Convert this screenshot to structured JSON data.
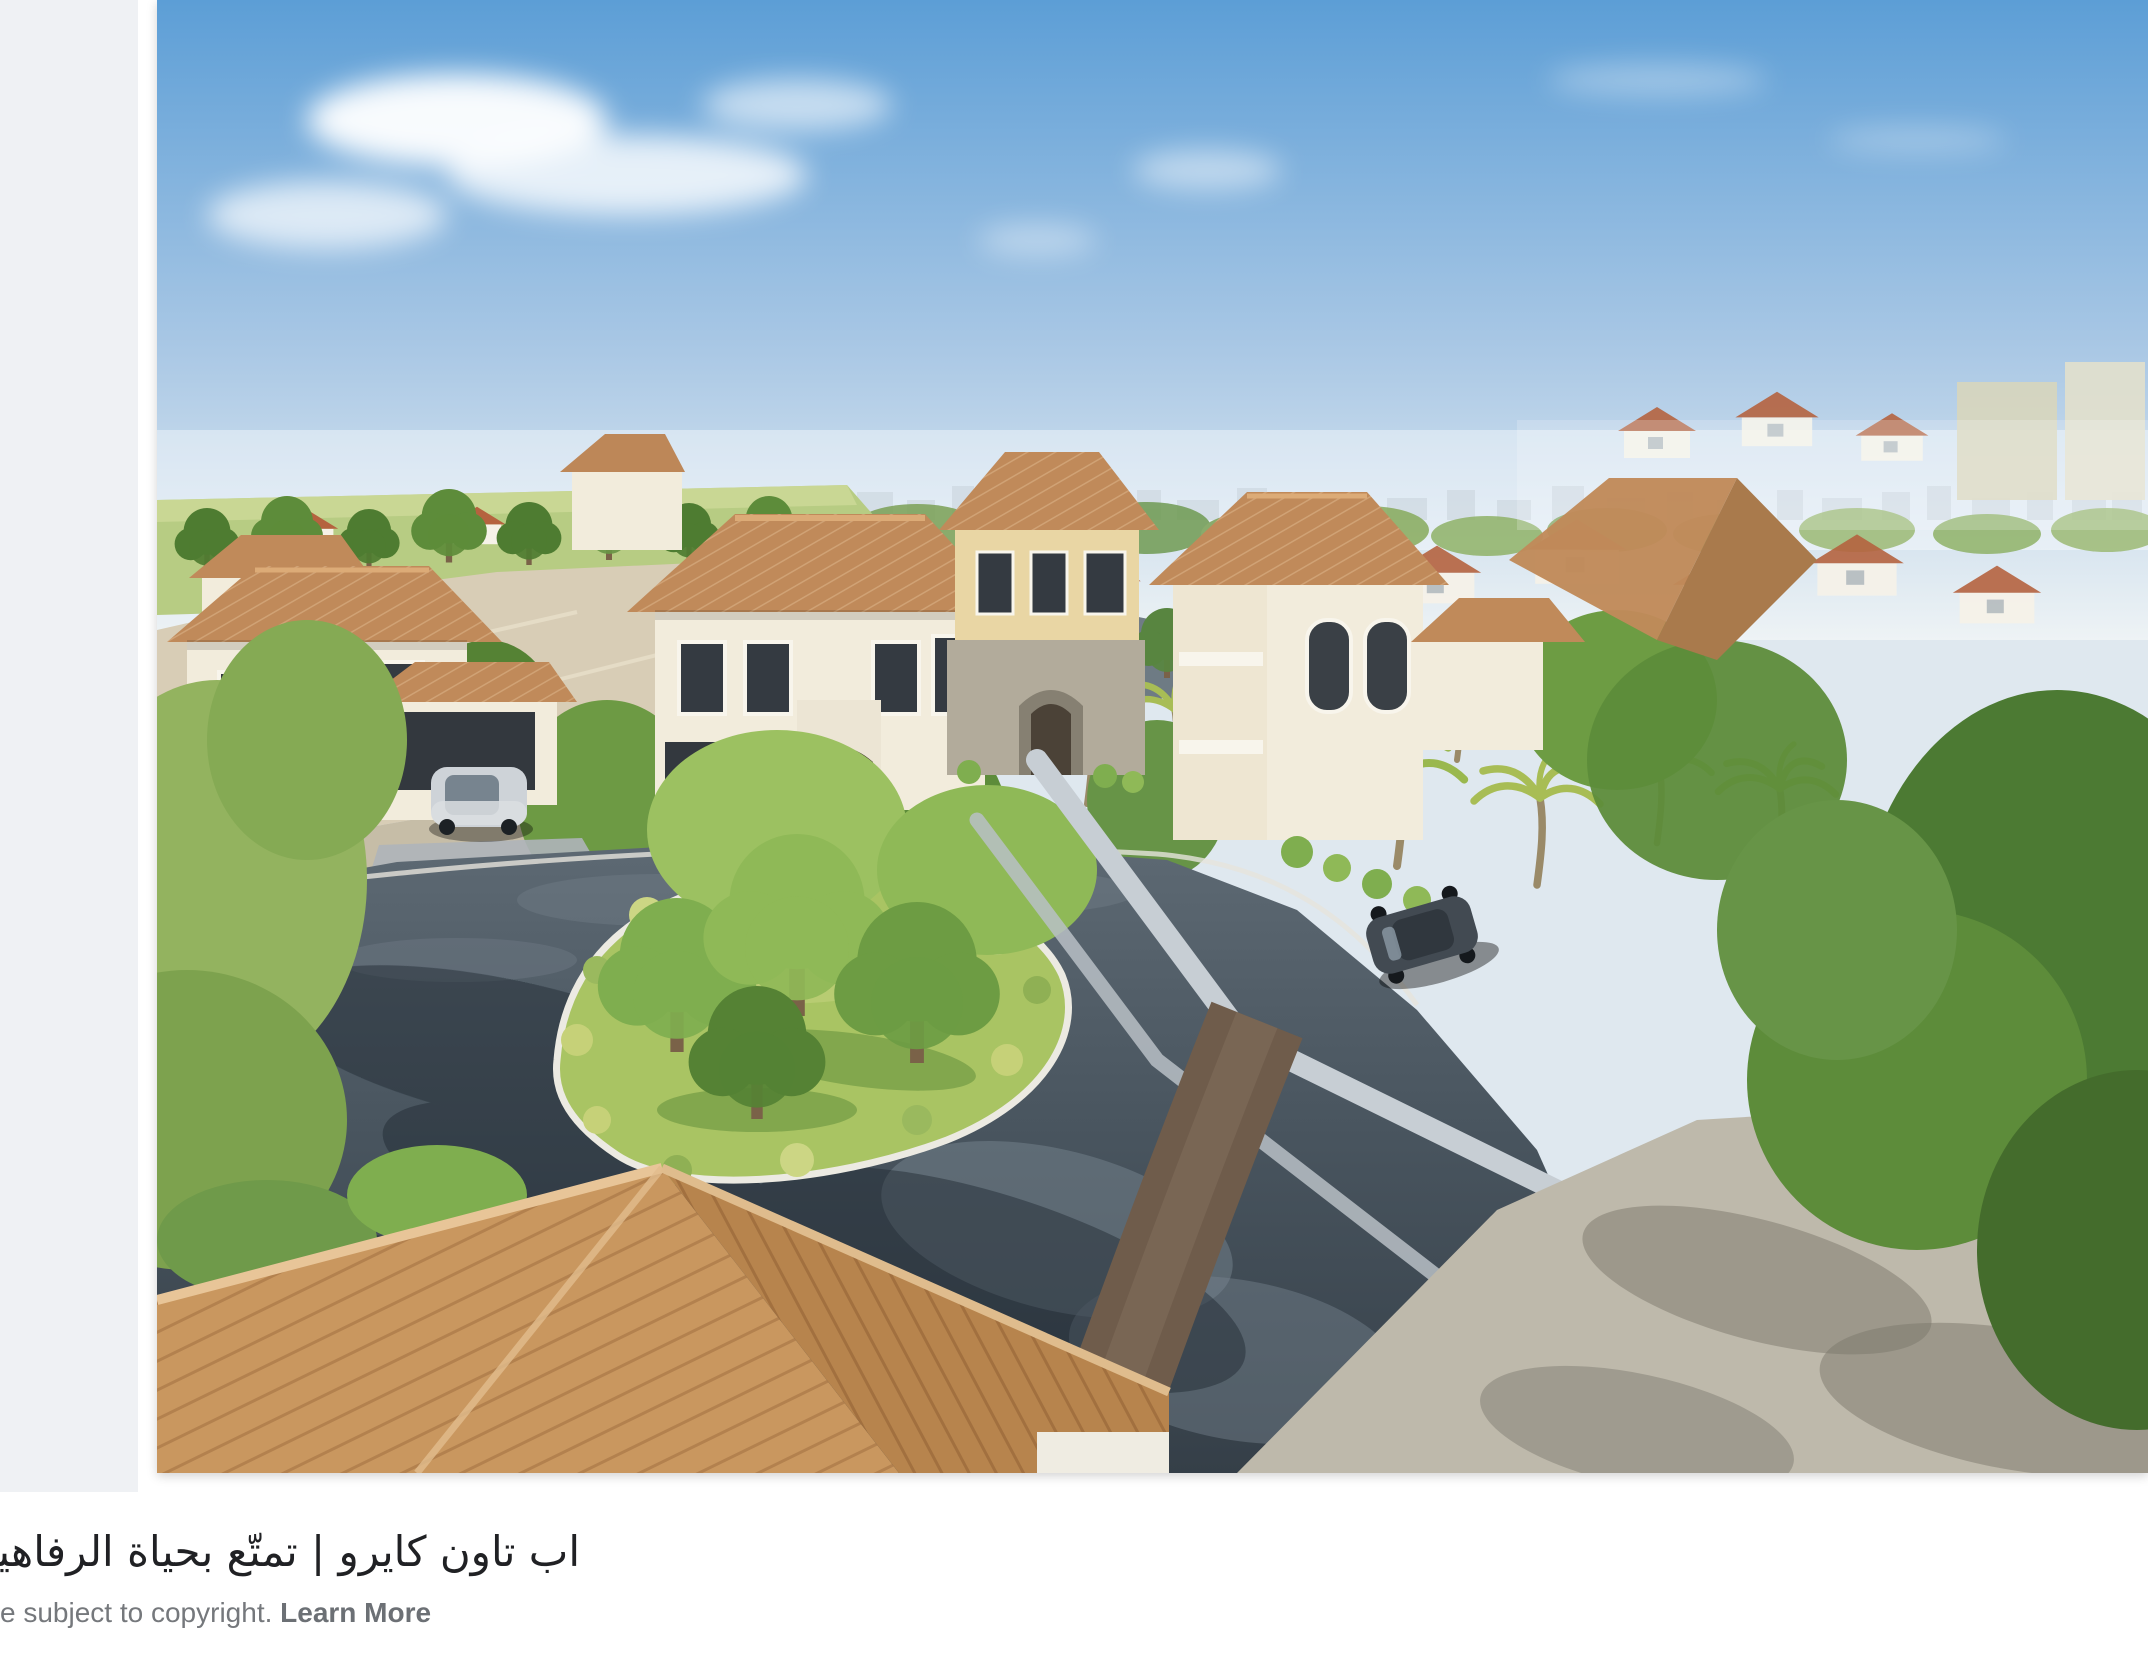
{
  "caption": {
    "title": "اب تاون كايرو | تمتّع بحياة الرفاهية فى قلب القا",
    "copyright_prefix": "e subject to copyright. ",
    "learn_more": "Learn More"
  },
  "preview": {
    "alt": "Aerial 3D rendering of a luxury villa compound: cream villas with terracotta tile roofs, green trees, a landscaped traffic island and curving dark asphalt streets, limestone quarry cliff and hazy city skyline in the distance"
  },
  "colors": {
    "page_bg": "#ffffff",
    "panel_bg": "#eff1f4",
    "title_text": "#202124",
    "muted_text": "#75787c"
  },
  "scene": {
    "palette": {
      "sky_top": "#5c9ed6",
      "sky_mid": "#aac8e5",
      "sky_haze": "#eef3f5",
      "cliff": "#d8cdb6",
      "cliff_shade": "#c3b89f",
      "far_grass": "#b7cc83",
      "tree_dark": "#4e7c31",
      "tree_mid": "#699647",
      "tree_light": "#93b35f",
      "wall_cream": "#f2ecdc",
      "wall_beige": "#e9d6a4",
      "wall_stone": "#b2ab9b",
      "roof_terracotta": "#c08a5a",
      "roof_fore_left": "#c9975f",
      "roof_fore_right": "#b7844d",
      "asphalt_light": "#5d6973",
      "asphalt": "#49555f",
      "asphalt_dark": "#353f48",
      "island_grass": "#a9c463",
      "paving": "#beb9ab",
      "concrete_wall": "#c7ced4",
      "brown_band": "#6f5c4b",
      "car_dark": "#424a52",
      "car_silver": "#ced3d8"
    }
  }
}
